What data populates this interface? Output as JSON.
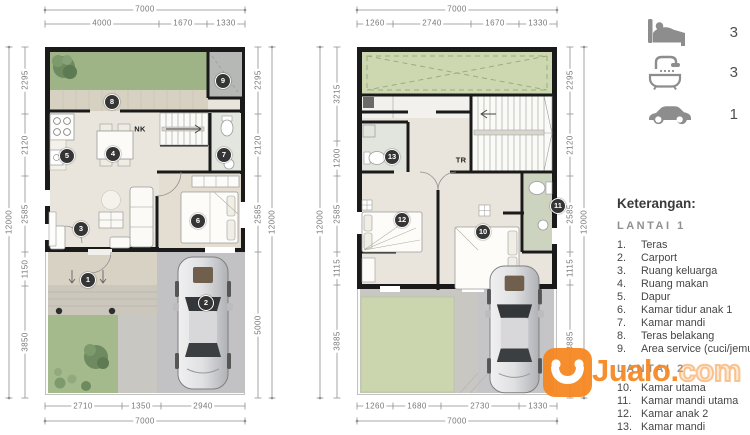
{
  "summary": {
    "bedrooms": "3",
    "bathrooms": "3",
    "carport": "1"
  },
  "plan1": {
    "stair_label": "NK",
    "badges": [
      "1",
      "2",
      "3",
      "4",
      "5",
      "6",
      "7",
      "8",
      "9"
    ],
    "dims": {
      "top_total": "7000",
      "top": [
        "4000",
        "1670",
        "1330"
      ],
      "bottom": [
        "2710",
        "1350",
        "2940"
      ],
      "bottom_total": "7000",
      "left": [
        "2295",
        "2120",
        "2585",
        "1150",
        "3850"
      ],
      "left_total": "12000",
      "right": [
        "2295",
        "2120",
        "2585",
        "5000"
      ],
      "right_total": "12000"
    }
  },
  "plan2": {
    "stair_label": "TR",
    "badges": [
      "10",
      "11",
      "12",
      "13"
    ],
    "dims": {
      "top_total": "7000",
      "top": [
        "1260",
        "2740",
        "1670",
        "1330"
      ],
      "bottom": [
        "1260",
        "1680",
        "2730",
        "1330"
      ],
      "bottom_total": "7000",
      "left": [
        "3215",
        "1200",
        "2585",
        "1115",
        "3885"
      ],
      "left_total": "12000",
      "right": [
        "2295",
        "2120",
        "2585",
        "1115",
        "3885"
      ],
      "right_total": "12000"
    }
  },
  "legend": {
    "title": "Keterangan:",
    "sections": [
      {
        "heading": "LANTAI 1",
        "items": [
          {
            "n": "1.",
            "t": "Teras"
          },
          {
            "n": "2.",
            "t": "Carport"
          },
          {
            "n": "3.",
            "t": "Ruang keluarga"
          },
          {
            "n": "4.",
            "t": "Ruang makan"
          },
          {
            "n": "5.",
            "t": "Dapur"
          },
          {
            "n": "6.",
            "t": "Kamar tidur anak 1"
          },
          {
            "n": "7.",
            "t": "Kamar mandi"
          },
          {
            "n": "8.",
            "t": "Teras belakang"
          },
          {
            "n": "9.",
            "t": "Area service (cuci/jemur)"
          }
        ]
      },
      {
        "heading": "LANTAI 2",
        "items": [
          {
            "n": "10.",
            "t": "Kamar utama"
          },
          {
            "n": "11.",
            "t": "Kamar mandi utama"
          },
          {
            "n": "12.",
            "t": "Kamar anak 2"
          },
          {
            "n": "13.",
            "t": "Kamar mandi"
          }
        ]
      }
    ]
  },
  "watermark": {
    "brand": "Jualo",
    "dot": ".",
    "suffix": "com"
  },
  "colors": {
    "accent_orange": "#f6861f",
    "wall": "#1a1a1a",
    "grass": "#9eb386",
    "dim_gray": "#8f8f8f"
  }
}
